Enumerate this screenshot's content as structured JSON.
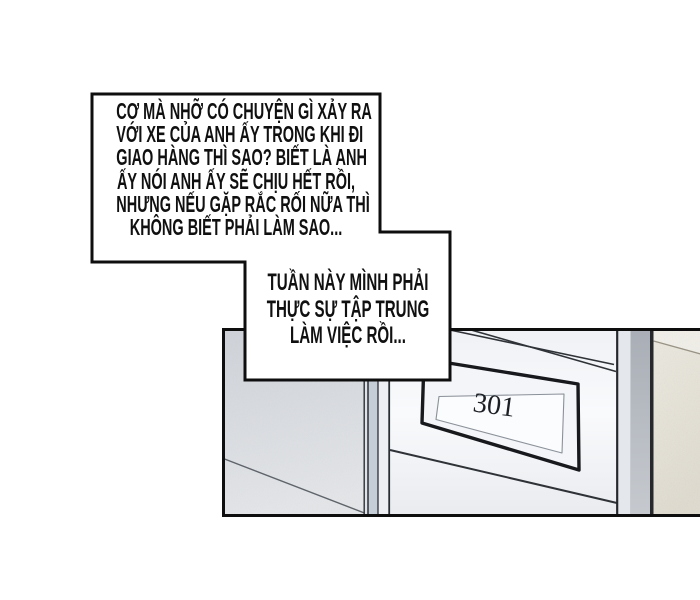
{
  "page": {
    "type": "comic-panel",
    "background": "#ffffff"
  },
  "speech": {
    "bubble1": {
      "lines": [
        "CƠ MÀ NHỠ CÓ CHUYỆN GÌ XẢY RA",
        "VỚI XE CỦA ANH ẤY TRONG KHI ĐI",
        "GIAO HÀNG THÌ SAO? BIẾT LÀ ANH",
        "ẤY NÓI ANH ẤY SẼ CHỊU HẾT RỒI,",
        "NHƯNG NẾU GẶP RẮC RỐI NỮA THÌ",
        "KHÔNG BIẾT PHẢI LÀM SAO..."
      ]
    },
    "bubble2": {
      "lines": [
        "TUẦN NÀY MÌNH PHẢI",
        "THỰC SỰ TẬP TRUNG",
        "LÀM VIỆC RỒI..."
      ]
    }
  },
  "scene": {
    "door_plate_number": "301"
  },
  "colors": {
    "ink": "#0e0e0e",
    "left_wall": "#d6d9de",
    "frame_strip_blue": "#c5cdd6",
    "frame_strip_light": "#edeff3",
    "door_face": "#f2f4f7",
    "right_frame_gray": "#b3b8bf",
    "right_wall_beige": "#e7e3d8",
    "plate_fill": "#f3f5f8",
    "plate_label_fill": "#fbfcfe",
    "text": "#101010"
  }
}
